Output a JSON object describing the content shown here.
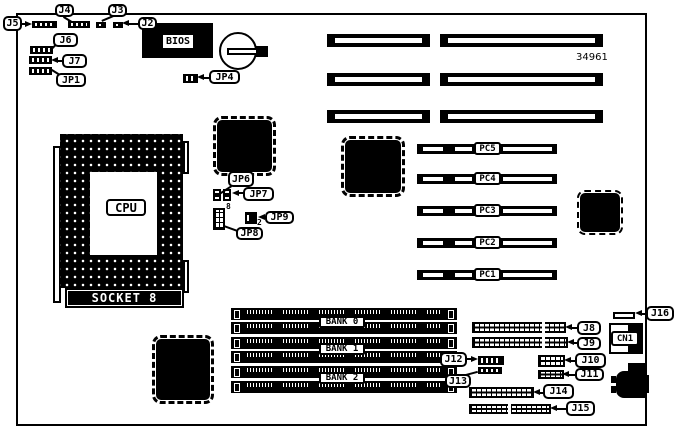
{
  "diagram": {
    "part_number": "34961",
    "colors": {
      "ink": "#000000",
      "paper": "#ffffff"
    },
    "cpu_label": "CPU",
    "socket_label": "SOCKET 8",
    "bios_label": "BIOS",
    "cn1_label": "CN1",
    "bank_labels": [
      "BANK 0",
      "BANK 1",
      "BANK 2"
    ],
    "pci_labels": [
      "PC5",
      "PC4",
      "PC3",
      "PC2",
      "PC1"
    ],
    "callouts": {
      "j2": "J2",
      "j3": "J3",
      "j4": "J4",
      "j5": "J5",
      "j6": "J6",
      "j7": "J7",
      "j8": "J8",
      "j9": "J9",
      "j10": "J10",
      "j11": "J11",
      "j12": "J12",
      "j13": "J13",
      "j14": "J14",
      "j15": "J15",
      "j16": "J16",
      "jp1": "JP1",
      "jp4": "JP4",
      "jp6": "JP6",
      "jp7": "JP7",
      "jp8": "JP8",
      "jp9": "JP9"
    },
    "pin_numbers": {
      "jp8": "8",
      "jp9": "2"
    }
  }
}
